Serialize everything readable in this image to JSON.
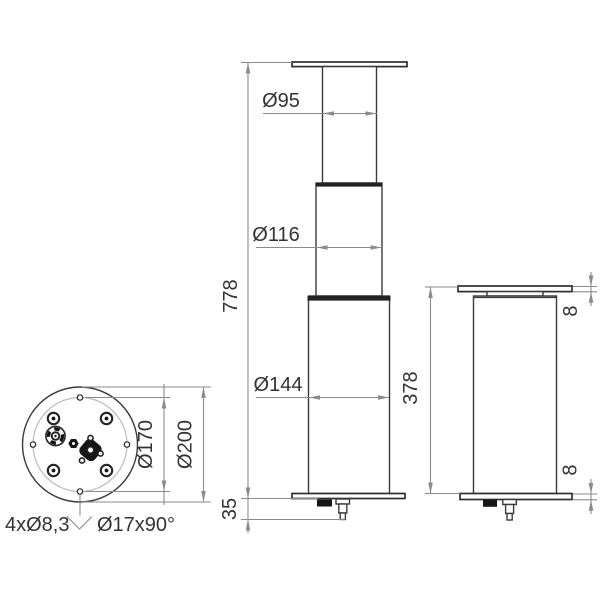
{
  "drawing": {
    "kind": "technical-dimension-drawing",
    "background": "#ffffff",
    "colors": {
      "part_line": "#3a3a3a",
      "dimension_line": "#8b8b8b",
      "text": "#333333",
      "bolt_circle": "#bcbcbc",
      "solid_fill": "#161616"
    },
    "labels": {
      "d95": "Ø95",
      "d116": "Ø116",
      "d144": "Ø144",
      "h778": "778",
      "h35": "35",
      "h378": "378",
      "t8_top": "8",
      "t8_bottom": "8",
      "d170": "Ø170",
      "d200": "Ø200",
      "holes_note": "4xØ8,3",
      "countersink_note": "Ø17x90°"
    },
    "symbols": {
      "countersink": "⌵"
    }
  }
}
